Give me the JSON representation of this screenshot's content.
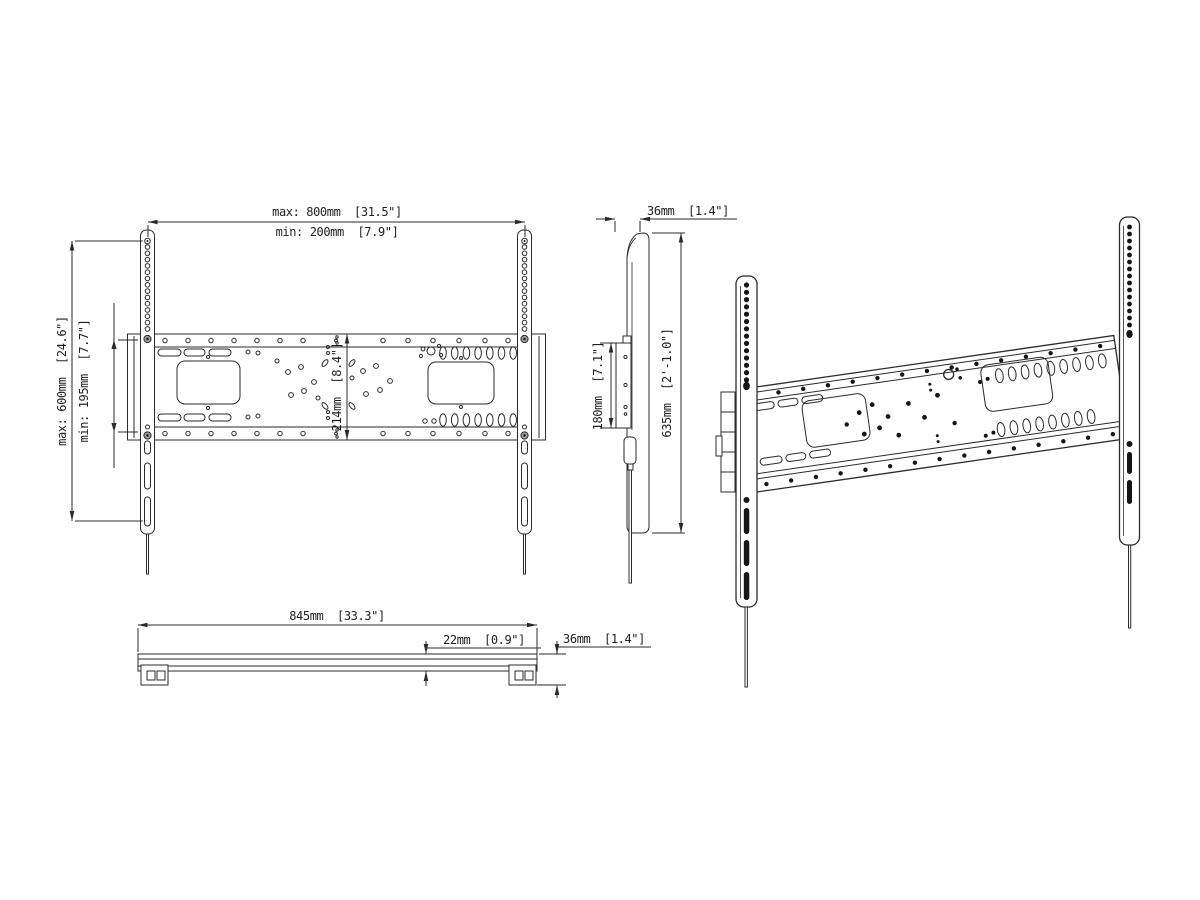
{
  "page": {
    "background": "#ffffff",
    "line_color": "#2b2b2b",
    "text_color": "#1f1f1f"
  },
  "views": {
    "front": {
      "dims": {
        "width_max": "max: 800mm  [31.5\"]",
        "width_min": "min: 200mm  [7.9\"]",
        "height_max": "max: 600mm  [24.6\"]",
        "height_min": "min: 195mm  [7.7\"]",
        "rail_span": "214mm  [8.4\"]"
      }
    },
    "side": {
      "dims": {
        "depth": "36mm  [1.4\"]",
        "plate_height": "180mm  [7.1\"]",
        "total_height": "635mm  [2'-1.0\"]"
      }
    },
    "bottom": {
      "dims": {
        "width": "845mm  [33.3\"]",
        "plate_thickness": "22mm  [0.9\"]",
        "total_depth": "36mm  [1.4\"]"
      }
    }
  }
}
